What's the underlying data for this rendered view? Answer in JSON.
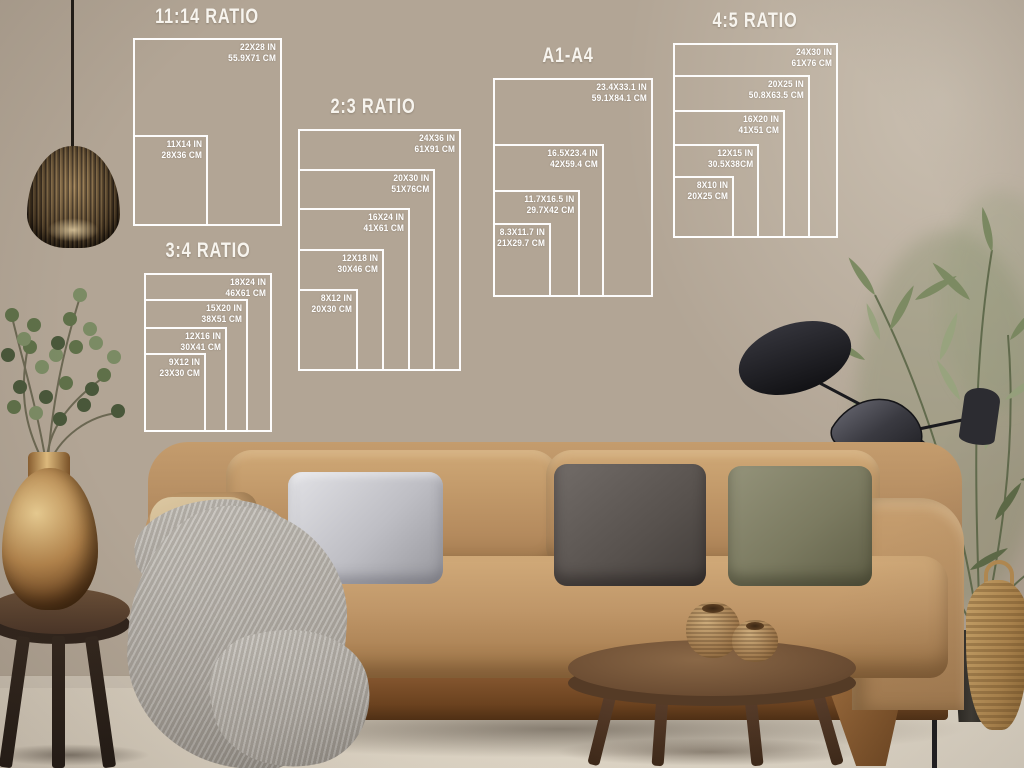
{
  "page": {
    "description": "Poster size guide mockup — white outline size charts on a living room wall"
  },
  "size_guide": {
    "line_color": "#ffffff",
    "text_color": "#ffffff",
    "groups": [
      {
        "title": "11:14 RATIO",
        "sizes": [
          {
            "in": "22X28 IN",
            "cm": "55.9X71 CM"
          },
          {
            "in": "11X14 IN",
            "cm": "28X36 CM"
          }
        ]
      },
      {
        "title": "2:3 RATIO",
        "sizes": [
          {
            "in": "24X36 IN",
            "cm": "61X91 CM"
          },
          {
            "in": "20X30 IN",
            "cm": "51X76CM"
          },
          {
            "in": "16X24 IN",
            "cm": "41X61 CM"
          },
          {
            "in": "12X18 IN",
            "cm": "30X46 CM"
          },
          {
            "in": "8X12 IN",
            "cm": "20X30 CM"
          }
        ]
      },
      {
        "title": "3:4 RATIO",
        "sizes": [
          {
            "in": "18X24 IN",
            "cm": "46X61 CM"
          },
          {
            "in": "15X20 IN",
            "cm": "38X51 CM"
          },
          {
            "in": "12X16 IN",
            "cm": "30X41 CM"
          },
          {
            "in": "9X12 IN",
            "cm": "23X30 CM"
          }
        ]
      },
      {
        "title": "A1-A4",
        "sizes": [
          {
            "in": "23.4X33.1 IN",
            "cm": "59.1X84.1 CM"
          },
          {
            "in": "16.5X23.4 IN",
            "cm": "42X59.4 CM"
          },
          {
            "in": "11.7X16.5 IN",
            "cm": "29.7X42 CM"
          },
          {
            "in": "8.3X11.7 IN",
            "cm": "21X29.7 CM"
          }
        ]
      },
      {
        "title": "4:5 RATIO",
        "sizes": [
          {
            "in": "24X30 IN",
            "cm": "61X76 CM"
          },
          {
            "in": "20X25 IN",
            "cm": "50.8X63.5 CM"
          },
          {
            "in": "16X20 IN",
            "cm": "41X51 CM"
          },
          {
            "in": "12X15 IN",
            "cm": "30.5X38CM"
          },
          {
            "in": "8X10 IN",
            "cm": "20X25 CM"
          }
        ]
      }
    ]
  },
  "scene": {
    "wall_color": "#b2a595",
    "wall_light": "#d8cfc0",
    "wall_dark": "#5d5348",
    "floor_color": "#ddd3c3",
    "sofa_color": "#b98f62",
    "pillow_silver": "#c7c7cb",
    "pillow_charcoal": "#5a5552",
    "pillow_olive": "#7e7d63",
    "blanket_color": "#b6b2ab",
    "wood_color": "#6b4a2e",
    "brass_color": "#b27e46",
    "plant_color": "#6f7d57",
    "lamp_color": "#1d1d20"
  }
}
